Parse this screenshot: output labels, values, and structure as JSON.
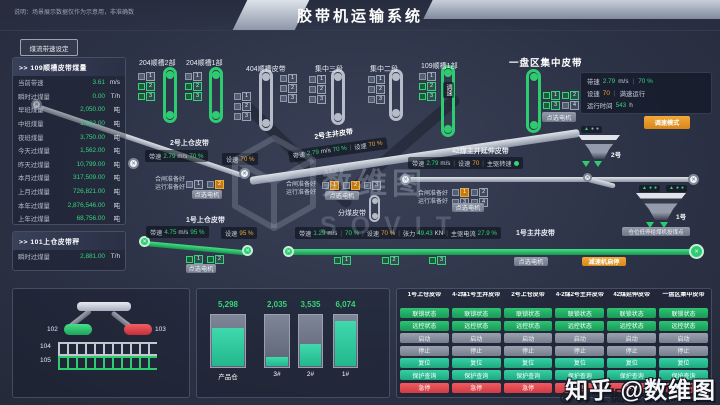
{
  "header": {
    "disclaimer": "说明：场景展示数据仅作为示意用，非准确数",
    "title": "胶带机运输系统",
    "speed_set_button": "煤流带速设定"
  },
  "panel_109": {
    "title": ">> 109顺槽皮带煤量",
    "rows": [
      {
        "label": "当前带速",
        "value": "3.61",
        "unit": "m/s"
      },
      {
        "label": "瞬时过煤量",
        "value": "0.00",
        "unit": "T/h"
      },
      {
        "label": "早班煤量",
        "value": "2,050.00",
        "unit": "吨"
      },
      {
        "label": "中班煤量",
        "value": "1,662.00",
        "unit": "吨"
      },
      {
        "label": "夜班煤量",
        "value": "3,750.00",
        "unit": "吨"
      },
      {
        "label": "今天过煤量",
        "value": "1,562.00",
        "unit": "吨"
      },
      {
        "label": "昨天过煤量",
        "value": "10,799.00",
        "unit": "吨"
      },
      {
        "label": "本月过煤量",
        "value": "317,509.00",
        "unit": "吨"
      },
      {
        "label": "上月过煤量",
        "value": "726,821.00",
        "unit": "吨"
      },
      {
        "label": "本年过煤量",
        "value": "2,876,546.00",
        "unit": "吨"
      },
      {
        "label": "上年过煤量",
        "value": "68,756.00",
        "unit": "吨"
      }
    ]
  },
  "panel_101": {
    "title": ">> 101上仓皮带秤",
    "rows": [
      {
        "label": "瞬时过煤量",
        "value": "2,881.00",
        "unit": "T/h"
      }
    ]
  },
  "top_belts": [
    {
      "name": "204顺槽2部",
      "state": "green",
      "tags": [
        {
          "n": "1",
          "c": "gray"
        },
        {
          "n": "2",
          "c": "green"
        },
        {
          "n": "3",
          "c": "green"
        }
      ]
    },
    {
      "name": "204顺槽1部",
      "state": "green",
      "tags": [
        {
          "n": "1",
          "c": "gray"
        },
        {
          "n": "2",
          "c": "green"
        },
        {
          "n": "3",
          "c": "green"
        }
      ]
    },
    {
      "name": "404顺槽皮带",
      "state": "gray",
      "tags": [
        {
          "n": "1",
          "c": "gray"
        },
        {
          "n": "2",
          "c": "gray"
        },
        {
          "n": "3",
          "c": "gray"
        }
      ],
      "tags_right": [
        {
          "n": "1",
          "c": "gray"
        },
        {
          "n": "2",
          "c": "gray"
        },
        {
          "n": "3",
          "c": "gray"
        }
      ]
    },
    {
      "name": "集中三段",
      "state": "gray",
      "tags": [
        {
          "n": "1",
          "c": "gray"
        },
        {
          "n": "2",
          "c": "gray"
        },
        {
          "n": "3",
          "c": "gray"
        }
      ]
    },
    {
      "name": "集中二段",
      "state": "gray",
      "tags": [
        {
          "n": "1",
          "c": "gray"
        },
        {
          "n": "2",
          "c": "gray"
        },
        {
          "n": "3",
          "c": "gray"
        }
      ]
    },
    {
      "name": "109顺槽1部",
      "state": "green",
      "speed_tag": "调速",
      "tags": [
        {
          "n": "1",
          "c": "gray"
        },
        {
          "n": "2",
          "c": "green"
        },
        {
          "n": "3",
          "c": "green"
        }
      ]
    }
  ],
  "pan_belt": {
    "title": "一盘区集中皮带",
    "speed_label": "带速",
    "speed": "2.79",
    "speed_unit": "m/s",
    "speed_pct": "70 %",
    "set_label": "设速",
    "set": "70",
    "set_note": "满速运行",
    "runtime_label": "运行时间",
    "runtime": "543",
    "runtime_unit": "h",
    "tags": [
      {
        "n": "1",
        "c": "green"
      },
      {
        "n": "2",
        "c": "green"
      },
      {
        "n": "3",
        "c": "green"
      },
      {
        "n": "4",
        "c": "gray"
      }
    ],
    "select_motor": "点选电机",
    "mode_button": "调速模式"
  },
  "c2u": {
    "label": "2号上仓皮带",
    "speed_label": "带速",
    "speed": "2.79",
    "unit": "m/s",
    "pct": "70 %",
    "set_label": "设速",
    "set": "70 %",
    "ready1": "合闸准备好",
    "ready2": "运行准备好",
    "tags": [
      {
        "n": "1",
        "c": "gray"
      },
      {
        "n": "2",
        "c": "orange"
      }
    ],
    "select": "点选电机"
  },
  "c2m": {
    "label": "2号主井皮带",
    "speed_label": "带速",
    "speed": "2.79",
    "unit": "m/s",
    "pct": "70 %",
    "set_label": "设速",
    "set": "70 %"
  },
  "c42": {
    "label": "42煤主井延伸皮带",
    "speed_label": "带速",
    "speed": "2.79",
    "unit": "m/s",
    "set_label": "设速",
    "set": "70",
    "drive_label": "主驱转速",
    "ready1": "合闸准备好",
    "ready2": "运行准备好",
    "tags": [
      {
        "n": "1",
        "c": "orange"
      },
      {
        "n": "2",
        "c": "gray"
      },
      {
        "n": "3",
        "c": "gray"
      },
      {
        "n": "4",
        "c": "gray"
      }
    ],
    "select": "点选电机"
  },
  "splitter": {
    "label": "分煤皮带",
    "ready1": "合闸准备好",
    "ready2": "运行准备好",
    "tags": [
      {
        "n": "1",
        "c": "orange"
      },
      {
        "n": "2",
        "c": "orange"
      },
      {
        "n": "3",
        "c": "gray"
      }
    ],
    "select": "点选电机"
  },
  "c1u": {
    "label": "1号上仓皮带",
    "speed_label": "带速",
    "speed": "4.75",
    "unit": "m/s",
    "pct": "95 %",
    "set_label": "设速",
    "set": "95 %",
    "tags": [
      {
        "n": "1",
        "c": "green"
      },
      {
        "n": "2",
        "c": "green"
      }
    ],
    "select": "点选电机"
  },
  "c1m": {
    "label": "1号主井皮带",
    "speed_label": "带速",
    "speed": "1.29",
    "unit": "m/s",
    "pct": "70 %",
    "set_label": "设速",
    "set": "70 %",
    "tension_label": "张力",
    "tension": "49.43",
    "tension_unit": "KN",
    "current_label": "主驱电流",
    "current": "27.9 %",
    "tags": [
      {
        "n": "1",
        "c": "green"
      },
      {
        "n": "2",
        "c": "green"
      },
      {
        "n": "3",
        "c": "green"
      }
    ],
    "select": "点选电机",
    "gear_button": "减速机启停",
    "low_stop_button": "仓位低停给煤机投煤点"
  },
  "hoppers": {
    "h2": "2号",
    "h1": "1号"
  },
  "chute": {
    "l102": "102",
    "l103": "103",
    "l104": "104",
    "l105": "105"
  },
  "silos": {
    "items": [
      {
        "label": "产品仓",
        "value": "5,298",
        "fill": 73
      },
      {
        "label": "3#",
        "value": "2,035",
        "fill": 18
      },
      {
        "label": "2#",
        "value": "3,535",
        "fill": 42
      },
      {
        "label": "1#",
        "value": "6,074",
        "fill": 86
      }
    ]
  },
  "chart_data": {
    "type": "bar",
    "categories": [
      "产品仓",
      "3#",
      "2#",
      "1#"
    ],
    "values": [
      5298,
      2035,
      3535,
      6074
    ],
    "title": "仓位煤量"
  },
  "control_panel": {
    "columns": [
      "1号上仓皮带",
      "4-2煤1号主井皮带",
      "2号上仓皮带",
      "4-2煤2号主井皮带",
      "42煤延伸皮带",
      "一盘区集中皮带"
    ],
    "buttons": [
      {
        "label": "联锁状态",
        "style": "green"
      },
      {
        "label": "远控状态",
        "style": "green"
      },
      {
        "label": "启动",
        "style": "gray"
      },
      {
        "label": "停止",
        "style": "gray"
      },
      {
        "label": "复位",
        "style": "teal"
      },
      {
        "label": "保护查询",
        "style": "teal"
      },
      {
        "label": "急停",
        "style": "red"
      }
    ]
  },
  "watermark": {
    "center_cn": "数维图",
    "center_en": "SOVIT",
    "corner": "知乎 @数维图",
    "corner_sub": "@稀土掘金技术社区"
  },
  "colors": {
    "green": "#2ecc71",
    "orange": "#e8942e",
    "red": "#e0484f",
    "teal": "#2fbf9b"
  }
}
